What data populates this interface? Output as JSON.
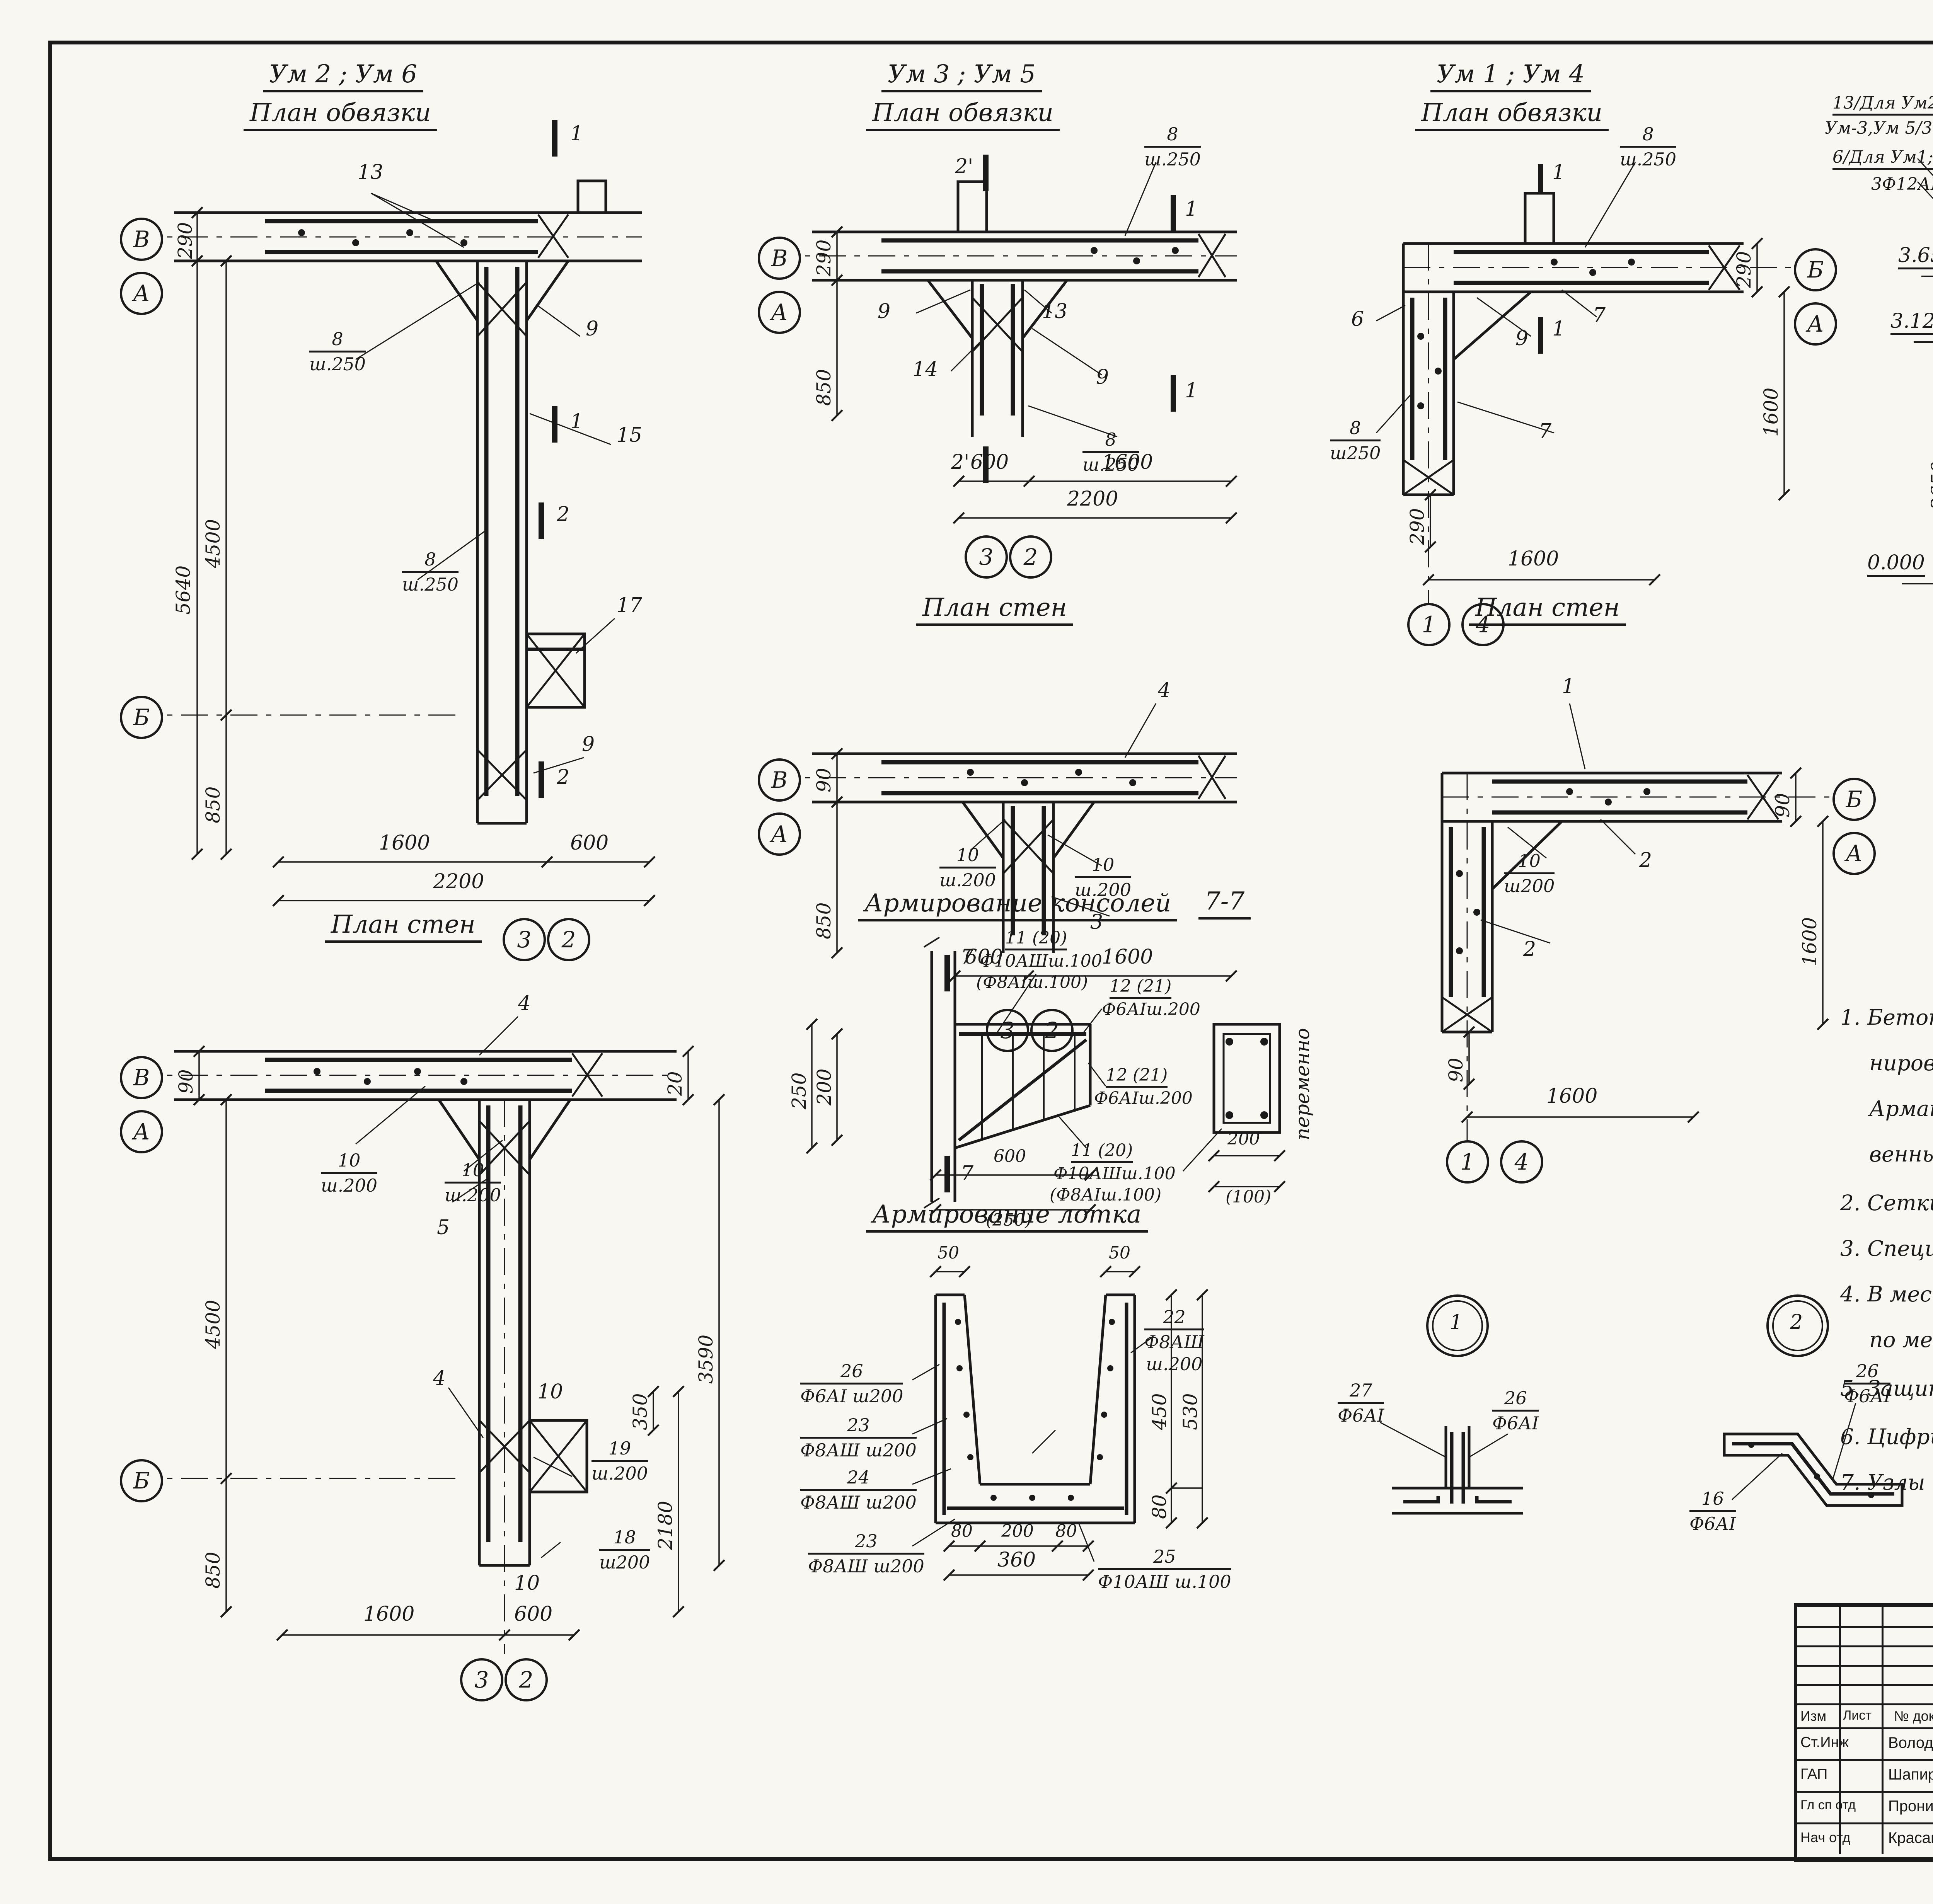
{
  "page": {
    "footer_doc": "15894-03",
    "footer_sheet": "13"
  },
  "plans": {
    "um26": {
      "title1": "Ум 2 ; Ум 6",
      "title2": "План обвязки",
      "mark1": "1",
      "mark1b": "1",
      "mark2": "2",
      "mark2b": "2",
      "g_v": "В",
      "g_a": "А",
      "g_b": "Б",
      "g_3": "3",
      "g_2": "2",
      "lbl13": "13",
      "lbl9": "9",
      "lbl15": "15",
      "lbl17": "17",
      "lbl9b": "9",
      "f8n": "8",
      "f8d": "ш.250",
      "f8n2": "8",
      "f8d2": "ш.250",
      "dim290": "290",
      "dim5640": "5640",
      "dim4500": "4500",
      "dim850": "850",
      "dim1600": "1600",
      "dim600": "600",
      "dim2200": "2200"
    },
    "um35": {
      "title1": "Ум 3 ; Ум 5",
      "title2": "План обвязки",
      "mark1": "1",
      "mark1b": "1",
      "mark2": "2'",
      "mark2b": "2'",
      "g_v": "В",
      "g_a": "А",
      "g_3": "3",
      "g_2": "2",
      "lbl9": "9",
      "lbl14": "14",
      "lbl13": "13",
      "lbl9b": "9",
      "f8n": "8",
      "f8d": "ш.250",
      "f8n2": "8",
      "f8d2": "ш.250",
      "dim290": "290",
      "dim850": "850",
      "dim600": "600",
      "dim1600": "1600",
      "dim2200": "2200"
    },
    "um14": {
      "title1": "Ум 1 ; Ум 4",
      "title2": "План обвязки",
      "mark1": "1",
      "mark1b": "1",
      "g_b": "Б",
      "g_a": "А",
      "g_1": "1",
      "g_4": "4",
      "lbl6": "6",
      "lbl9": "9",
      "lbl7": "7",
      "lbl7b": "7",
      "f8n": "8",
      "f8d": "ш.250",
      "f8n2": "8",
      "f8d2": "ш250",
      "dim290": "290",
      "dim1600": "1600",
      "dim290b": "290",
      "dim1600b": "1600"
    },
    "psten_mid": {
      "title": "План стен",
      "g_v": "В",
      "g_a": "А",
      "g_3": "3",
      "g_2": "2",
      "lbl4": "4",
      "lbl3": "3",
      "f10n": "10",
      "f10d": "ш.200",
      "f10n2": "10",
      "f10d2": "ш.200",
      "dim90": "90",
      "dim850": "850",
      "dim600": "600",
      "dim1600": "1600"
    },
    "psten_right": {
      "title": "План стен",
      "g_b": "Б",
      "g_a": "А",
      "g_1": "1",
      "g_4": "4",
      "lbl1": "1",
      "lbl2": "2",
      "lbl2b": "2",
      "f10n": "10",
      "f10d": "ш200",
      "dim90": "90",
      "dim1600": "1600",
      "dim90b": "90",
      "dim1600b": "1600"
    },
    "psten_big": {
      "title": "План стен",
      "g_v": "В",
      "g_a": "А",
      "g_b": "Б",
      "g_3": "3",
      "g_2": "2",
      "lbl4": "4",
      "lbl4b": "4",
      "lbl5": "5",
      "lbl10": "10",
      "lbl10b": "10",
      "f10n": "10",
      "f10d": "ш.200",
      "f10n2": "10",
      "f10d2": "ш.200",
      "f19n": "19",
      "f19d": "ш.200",
      "f18n": "18",
      "f18d": "ш200",
      "dim90": "90",
      "dim20": "20",
      "dim4500": "4500",
      "dim850": "850",
      "dim3590": "3590",
      "dim350": "350",
      "dim2180": "2180",
      "dim1600": "1600",
      "dim600": "600"
    }
  },
  "sections": {
    "s11": {
      "title": "1-1",
      "fr_n": "8",
      "fr_d1": "Ф6АI",
      "fr_d2": "ш.250",
      "left1": "13/Для Ум2;Ум6",
      "left2": "Ум-3,Ум 5/3Ф12АШ",
      "left3": "6/Для Ум1;Ум4/",
      "left4": "3Ф12АШ",
      "right1": "13,Для Ум2;Ум6;",
      "right2": "Ум3,Ум5,3Ф12АШ",
      "right3": "7/Ум1;Ум4/",
      "right4": "3Ф12АШ",
      "dim200": "200",
      "dim180": "180",
      "lev3650": "3.650",
      "lev3120": "3.120",
      "lev3050": "3 050",
      "mn": "МН",
      "dim530": "530",
      "dim100a": "100",
      "dim100b": "100",
      "dim600a": "600",
      "dim300": "300",
      "dim600b": "600",
      "dim3650": "3650",
      "lbl124": "1;2;4",
      "lev0": "0.000",
      "dim400": "400"
    },
    "s22": {
      "title": "2-2 ; 2'-2'",
      "fr_n": "8",
      "fr_d1": "Ф6АI",
      "left1": "13/Ум2;Ум6;",
      "left2": "Ум3,Ум5/3Ф12АШ",
      "left3": "17/Ум2,Ум6",
      "left4": "3Ф12АШ",
      "right1": "17/Ум2;Ум6/",
      "right2": "3Ф12АШ",
      "right3": "13;Ум2;Ум6",
      "right4": "Ум3,Ум5/3Ф12АШ",
      "lev3650": "3.650",
      "lev2650": "2.650",
      "dim200": "200",
      "dim180": "180",
      "dim1000": "1000",
      "dim350": "350",
      "dim200b": "200",
      "dim100": "100",
      "dim150": "150",
      "dim250": "250",
      "only_a1": "Только для",
      "only_a2": "2-2",
      "only_b1": "Только для",
      "only_b2": "2'-2'",
      "lbl194": "19;4",
      "dim3650": "3650",
      "lev0": "0.000",
      "dim400": "400"
    }
  },
  "arm_kons": {
    "title": "Армирование консолей",
    "sect": "7-7",
    "mark7": "7",
    "mark7b": "7",
    "top1": "11 (20)",
    "top2": "Ф10АШш.100",
    "top3": "(Ф8АIш.100)",
    "r1": "12 (21)",
    "r2": "Ф6АIш.200",
    "mid1": "12 (21)",
    "mid2": "Ф6АIш.200",
    "bot1": "11 (20)",
    "bot2": "Ф10АШш.100",
    "bot3": "(Ф8АIш.100)",
    "dim250": "250",
    "dim200": "200",
    "dim600": "600",
    "dim250p": "(250)",
    "dim200r": "200",
    "dim100p": "(100)",
    "vertlbl": "переменно"
  },
  "arm_lotka": {
    "title": "Армирование лотка",
    "dim50a": "50",
    "dim50b": "50",
    "l26n": "26",
    "l26d": "Ф6АI ш200",
    "l23n": "23",
    "l23d": "Ф8АШ ш200",
    "l24n": "24",
    "l24d": "Ф8АШ ш200",
    "l22n": "22",
    "l22d": "Ф8АШ",
    "l22d2": "ш.200",
    "l23bn": "23",
    "l23bd": "Ф8АШ ш200",
    "l25n": "25",
    "l25d": "Ф10АШ ш.100",
    "dim450": "450",
    "dim530": "530",
    "dim80r": "80",
    "dim80a": "80",
    "dim200": "200",
    "dim80b": "80",
    "dim360": "360"
  },
  "node1": {
    "num": "1",
    "a_n": "27",
    "a_d": "Ф6АI",
    "b_n": "26",
    "b_d": "Ф6АI"
  },
  "node2": {
    "num": "2",
    "a_n": "26",
    "a_d": "Ф6АI",
    "b_n": "16",
    "b_d": "Ф6АI"
  },
  "notes": [
    "1. Бетонирование  консолей  вести  совместно  с  бето-",
    "нированием  монолитных  участков  стен.",
    "Арматурные  стержни  консолей  сварить  в  пространст-",
    "венный  каркас.",
    "2. Сетки  разработаны  на  листе  КЖ-8.",
    "3. Спецификацию  и  выборку  арматуры  см. лист.  КЖ-9.",
    "4. В  местах  установки  сальников  арматуру  вырезать",
    "по  месту  и  приварить  к  корпусу  сальника.",
    "5. Защитный  слой  бетона - 20 мм.",
    "6. Цифры  в  скобках  даны  для  консоли  вылетом 250 мм.",
    "7. Узлы  1 ; 2  замаркированы  на  листе  КЖ-6."
  ],
  "stamp": {
    "code": "ТП 902.2-321",
    "code2": "-КЖ",
    "proj1": "Станция биологической очистки сточных вод в аэротенках",
    "proj2": "продленной аэрации с аэраторами на вертикальном валу",
    "proj3": "производительностью 200 м3/сутки",
    "obj1": "Блок емкостей",
    "obj2": "АМ-330",
    "doc1": "Монолитные конструкции",
    "doc2": "Армирование",
    "org1": "ЦНИИЭП",
    "org2": "инженерного оборудования",
    "org3": "г Москва",
    "h_izm": "Изм",
    "h_list": "Лист",
    "h_doc": "№ докум",
    "h_sign": "Подпись",
    "h_date": "Дата",
    "r1a": "Ст.Инж",
    "r1b": "Володин",
    "r2a": "ГАП",
    "r2b": "Шапиро",
    "r3a": "Гл сп отд",
    "r3b": "Пронин",
    "r4a": "Нач отд",
    "r4b": "Красавин",
    "h_lit": "Лит",
    "h_sheet": "Лист",
    "h_sheets": "Листов",
    "v_lit": "Р",
    "v_sheet": "7"
  }
}
